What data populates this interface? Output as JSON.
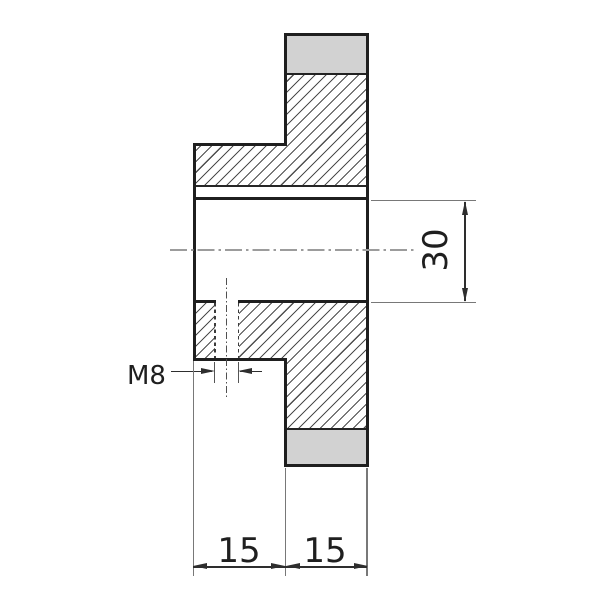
{
  "drawing": {
    "labels": {
      "thread_callout": "M8",
      "bore_diameter": "30",
      "width_left": "15",
      "width_right": "15"
    },
    "colors": {
      "background": "#ffffff",
      "outline": "#1f1f1f",
      "section_fill": "#d2d2d2",
      "hatch_line": "#4d4d4d",
      "centerline": "#9c9c9c",
      "dimension_line": "#2e2e2e",
      "text": "#1f1f1f"
    }
  }
}
